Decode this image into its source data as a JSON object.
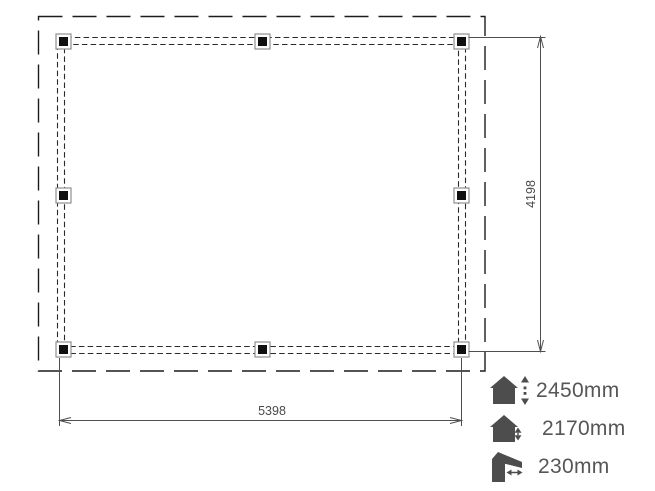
{
  "plan": {
    "width_label": "5398",
    "height_label": "4198",
    "post_count": 8
  },
  "legend": {
    "items": [
      {
        "icon": "house-total-height-icon",
        "label": "2450mm"
      },
      {
        "icon": "house-wall-height-icon",
        "label": "2170mm"
      },
      {
        "icon": "roof-overhang-icon",
        "label": "230mm"
      }
    ]
  },
  "colors": {
    "drawing_line": "#1c1c1c",
    "dimension_line": "#4f4f4f",
    "legend_icon": "#4d4d4d",
    "legend_text": "#565656",
    "background": "#ffffff"
  }
}
